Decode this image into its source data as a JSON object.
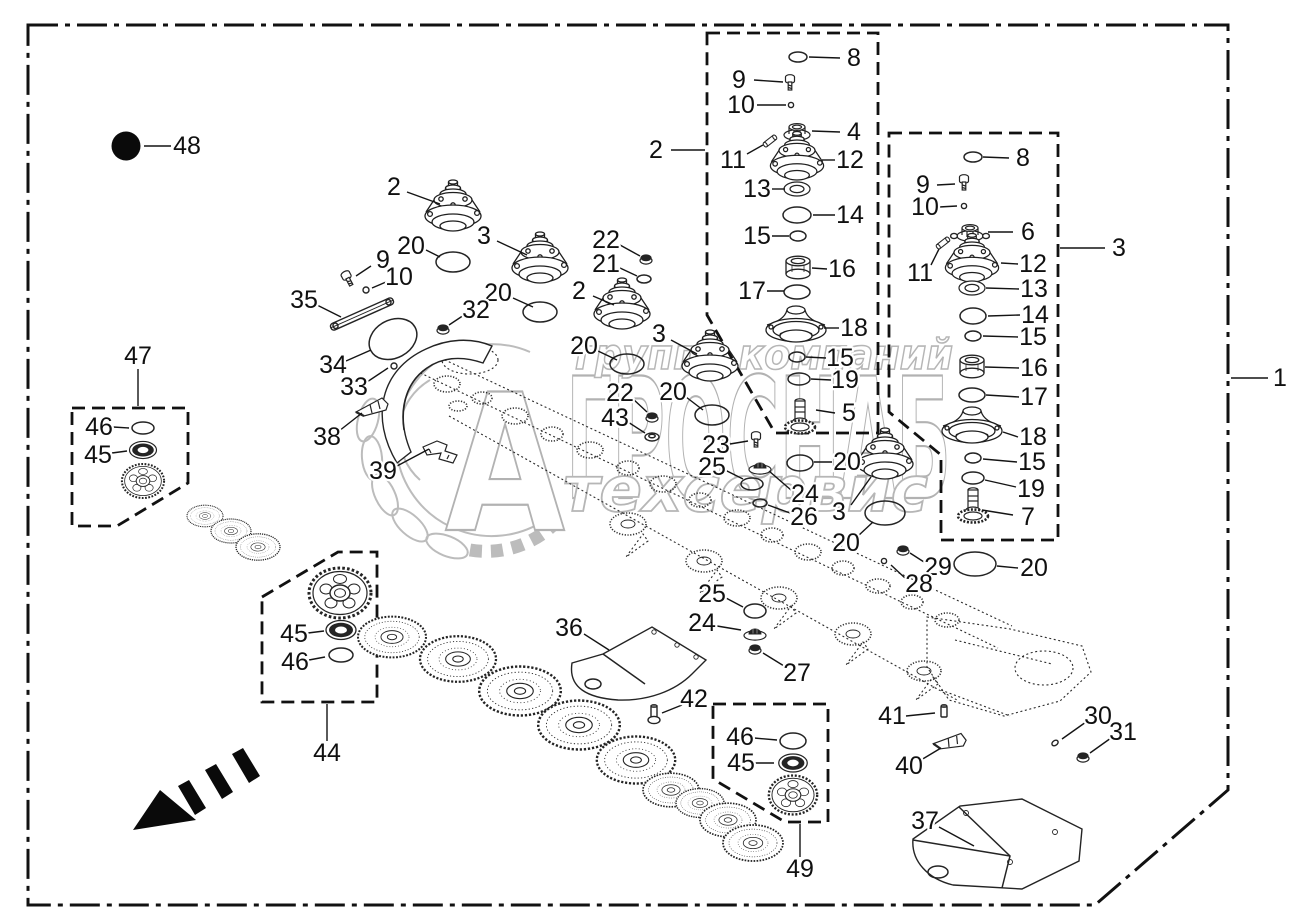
{
  "colors": {
    "line": "#1a1a1a",
    "watermark": "#b6b6b6",
    "background": "#ffffff",
    "accent": "#0a0a0a"
  },
  "watermark": {
    "row1": "группа компаний",
    "brand": "АГРОСНАБ",
    "monogram": "А",
    "brand_rest": "ГРОСНАБ",
    "row3": "техсервис"
  },
  "callouts": [
    {
      "n": "48",
      "x": 187,
      "y": 146,
      "l": [
        171,
        146,
        144,
        146
      ]
    },
    {
      "n": "1",
      "x": 1280,
      "y": 378,
      "l": [
        1268,
        378,
        1231,
        378
      ]
    },
    {
      "n": "2",
      "x": 656,
      "y": 150,
      "l": [
        671,
        150,
        705,
        150
      ]
    },
    {
      "n": "3",
      "x": 1119,
      "y": 248,
      "l": [
        1105,
        248,
        1060,
        248
      ]
    },
    {
      "n": "8",
      "x": 854,
      "y": 58,
      "l": [
        840,
        58,
        809,
        57
      ]
    },
    {
      "n": "9",
      "x": 739,
      "y": 80,
      "l": [
        754,
        80,
        783,
        82
      ]
    },
    {
      "n": "10",
      "x": 741,
      "y": 105,
      "l": [
        757,
        105,
        786,
        105
      ]
    },
    {
      "n": "4",
      "x": 854,
      "y": 132,
      "l": [
        840,
        132,
        812,
        131
      ]
    },
    {
      "n": "12",
      "x": 850,
      "y": 160,
      "l": [
        835,
        160,
        822,
        160
      ]
    },
    {
      "n": "11",
      "x": 733,
      "y": 160,
      "l": [
        747,
        154,
        763,
        145
      ]
    },
    {
      "n": "13",
      "x": 757,
      "y": 189,
      "l": [
        772,
        189,
        785,
        189
      ]
    },
    {
      "n": "14",
      "x": 850,
      "y": 215,
      "l": [
        835,
        215,
        813,
        215
      ]
    },
    {
      "n": "15",
      "x": 757,
      "y": 236,
      "l": [
        772,
        236,
        789,
        236
      ]
    },
    {
      "n": "16",
      "x": 842,
      "y": 269,
      "l": [
        827,
        269,
        812,
        268
      ]
    },
    {
      "n": "17",
      "x": 752,
      "y": 291,
      "l": [
        767,
        291,
        784,
        291
      ]
    },
    {
      "n": "18",
      "x": 854,
      "y": 328,
      "l": [
        839,
        328,
        824,
        328
      ]
    },
    {
      "n": "15",
      "x": 840,
      "y": 358,
      "l": [
        826,
        358,
        806,
        357
      ]
    },
    {
      "n": "19",
      "x": 845,
      "y": 380,
      "l": [
        831,
        380,
        811,
        379
      ]
    },
    {
      "n": "5",
      "x": 849,
      "y": 413,
      "l": [
        835,
        413,
        816,
        410
      ]
    },
    {
      "n": "20",
      "x": 847,
      "y": 462,
      "l": [
        832,
        462,
        814,
        462
      ]
    },
    {
      "n": "8",
      "x": 1023,
      "y": 158,
      "l": [
        1009,
        158,
        983,
        157
      ]
    },
    {
      "n": "9",
      "x": 923,
      "y": 185,
      "l": [
        937,
        185,
        955,
        184
      ]
    },
    {
      "n": "10",
      "x": 925,
      "y": 207,
      "l": [
        939,
        207,
        957,
        206
      ]
    },
    {
      "n": "6",
      "x": 1028,
      "y": 232,
      "l": [
        1013,
        232,
        988,
        232
      ]
    },
    {
      "n": "11",
      "x": 920,
      "y": 273,
      "l": [
        931,
        265,
        939,
        249
      ]
    },
    {
      "n": "12",
      "x": 1033,
      "y": 264,
      "l": [
        1018,
        264,
        1001,
        263
      ]
    },
    {
      "n": "13",
      "x": 1034,
      "y": 289,
      "l": [
        1019,
        289,
        986,
        288
      ]
    },
    {
      "n": "14",
      "x": 1035,
      "y": 315,
      "l": [
        1020,
        315,
        988,
        316
      ]
    },
    {
      "n": "15",
      "x": 1033,
      "y": 337,
      "l": [
        1018,
        337,
        983,
        336
      ]
    },
    {
      "n": "16",
      "x": 1034,
      "y": 368,
      "l": [
        1019,
        368,
        985,
        367
      ]
    },
    {
      "n": "17",
      "x": 1034,
      "y": 397,
      "l": [
        1019,
        397,
        986,
        395
      ]
    },
    {
      "n": "18",
      "x": 1033,
      "y": 437,
      "l": [
        1018,
        437,
        1003,
        432
      ]
    },
    {
      "n": "15",
      "x": 1032,
      "y": 462,
      "l": [
        1017,
        462,
        983,
        459
      ]
    },
    {
      "n": "19",
      "x": 1031,
      "y": 489,
      "l": [
        1016,
        487,
        985,
        480
      ]
    },
    {
      "n": "7",
      "x": 1028,
      "y": 517,
      "l": [
        1013,
        515,
        982,
        510
      ]
    },
    {
      "n": "20",
      "x": 1034,
      "y": 568,
      "l": [
        1018,
        568,
        997,
        566
      ]
    },
    {
      "n": "2",
      "x": 394,
      "y": 187,
      "l": [
        407,
        192,
        440,
        204
      ]
    },
    {
      "n": "3",
      "x": 484,
      "y": 236,
      "l": [
        497,
        241,
        527,
        255
      ]
    },
    {
      "n": "20",
      "x": 411,
      "y": 246,
      "l": [
        426,
        250,
        440,
        257
      ]
    },
    {
      "n": "9",
      "x": 383,
      "y": 260,
      "l": [
        371,
        266,
        356,
        276
      ]
    },
    {
      "n": "10",
      "x": 399,
      "y": 277,
      "l": [
        386,
        282,
        372,
        288
      ]
    },
    {
      "n": "22",
      "x": 606,
      "y": 240,
      "l": [
        620,
        245,
        640,
        256
      ]
    },
    {
      "n": "21",
      "x": 606,
      "y": 264,
      "l": [
        620,
        268,
        637,
        276
      ]
    },
    {
      "n": "2",
      "x": 579,
      "y": 291,
      "l": [
        593,
        296,
        614,
        305
      ]
    },
    {
      "n": "20",
      "x": 498,
      "y": 293,
      "l": [
        513,
        298,
        533,
        307
      ]
    },
    {
      "n": "35",
      "x": 304,
      "y": 300,
      "l": [
        317,
        305,
        341,
        317
      ]
    },
    {
      "n": "34",
      "x": 333,
      "y": 365,
      "l": [
        346,
        361,
        371,
        350
      ]
    },
    {
      "n": "32",
      "x": 476,
      "y": 310,
      "l": [
        464,
        315,
        449,
        325
      ]
    },
    {
      "n": "33",
      "x": 354,
      "y": 387,
      "l": [
        367,
        382,
        388,
        368
      ]
    },
    {
      "n": "38",
      "x": 327,
      "y": 437,
      "l": [
        339,
        431,
        362,
        413
      ]
    },
    {
      "n": "3",
      "x": 659,
      "y": 334,
      "l": [
        671,
        340,
        697,
        354
      ]
    },
    {
      "n": "20",
      "x": 584,
      "y": 346,
      "l": [
        598,
        351,
        617,
        360
      ]
    },
    {
      "n": "39",
      "x": 383,
      "y": 471,
      "l": [
        397,
        466,
        429,
        449
      ]
    },
    {
      "n": "22",
      "x": 620,
      "y": 393,
      "l": [
        632,
        398,
        647,
        412
      ]
    },
    {
      "n": "43",
      "x": 615,
      "y": 418,
      "l": [
        628,
        422,
        645,
        433
      ]
    },
    {
      "n": "20",
      "x": 673,
      "y": 392,
      "l": [
        686,
        397,
        703,
        410
      ]
    },
    {
      "n": "23",
      "x": 716,
      "y": 445,
      "l": [
        730,
        444,
        748,
        441
      ]
    },
    {
      "n": "25",
      "x": 712,
      "y": 467,
      "l": [
        725,
        470,
        743,
        479
      ]
    },
    {
      "n": "24",
      "x": 805,
      "y": 494,
      "l": [
        791,
        490,
        769,
        471
      ]
    },
    {
      "n": "26",
      "x": 804,
      "y": 517,
      "l": [
        790,
        513,
        768,
        505
      ]
    },
    {
      "n": "3",
      "x": 839,
      "y": 512,
      "l": [
        851,
        505,
        871,
        477
      ]
    },
    {
      "n": "20",
      "x": 846,
      "y": 543,
      "l": [
        858,
        536,
        873,
        522
      ]
    },
    {
      "n": "29",
      "x": 938,
      "y": 567,
      "l": [
        924,
        562,
        910,
        553
      ]
    },
    {
      "n": "28",
      "x": 919,
      "y": 584,
      "l": [
        905,
        578,
        891,
        565
      ]
    },
    {
      "n": "36",
      "x": 569,
      "y": 628,
      "l": [
        584,
        634,
        609,
        650
      ]
    },
    {
      "n": "25",
      "x": 712,
      "y": 594,
      "l": [
        726,
        598,
        743,
        607
      ]
    },
    {
      "n": "24",
      "x": 702,
      "y": 623,
      "l": [
        717,
        626,
        741,
        630
      ]
    },
    {
      "n": "27",
      "x": 797,
      "y": 673,
      "l": [
        784,
        666,
        763,
        653
      ]
    },
    {
      "n": "42",
      "x": 694,
      "y": 699,
      "l": [
        682,
        705,
        662,
        713
      ]
    },
    {
      "n": "41",
      "x": 892,
      "y": 716,
      "l": [
        906,
        716,
        935,
        713
      ]
    },
    {
      "n": "40",
      "x": 909,
      "y": 766,
      "l": [
        921,
        760,
        941,
        748
      ]
    },
    {
      "n": "30",
      "x": 1098,
      "y": 716,
      "l": [
        1086,
        722,
        1062,
        739
      ]
    },
    {
      "n": "31",
      "x": 1123,
      "y": 732,
      "l": [
        1111,
        738,
        1090,
        753
      ]
    },
    {
      "n": "37",
      "x": 925,
      "y": 821,
      "l": [
        939,
        827,
        974,
        846
      ]
    },
    {
      "n": "44",
      "x": 327,
      "y": 753,
      "l": [
        327,
        741,
        327,
        704
      ]
    },
    {
      "n": "47",
      "x": 138,
      "y": 356,
      "l": [
        138,
        369,
        138,
        406
      ]
    },
    {
      "n": "49",
      "x": 800,
      "y": 869,
      "l": [
        800,
        857,
        800,
        824
      ]
    },
    {
      "n": "46",
      "x": 99,
      "y": 427,
      "l": [
        113,
        427,
        129,
        428
      ]
    },
    {
      "n": "45",
      "x": 98,
      "y": 455,
      "l": [
        112,
        453,
        127,
        451
      ]
    },
    {
      "n": "45",
      "x": 294,
      "y": 634,
      "l": [
        308,
        633,
        324,
        631
      ]
    },
    {
      "n": "46",
      "x": 295,
      "y": 662,
      "l": [
        309,
        660,
        325,
        657
      ]
    },
    {
      "n": "46",
      "x": 740,
      "y": 737,
      "l": [
        754,
        738,
        777,
        740
      ]
    },
    {
      "n": "45",
      "x": 741,
      "y": 763,
      "l": [
        755,
        763,
        774,
        763
      ]
    }
  ]
}
